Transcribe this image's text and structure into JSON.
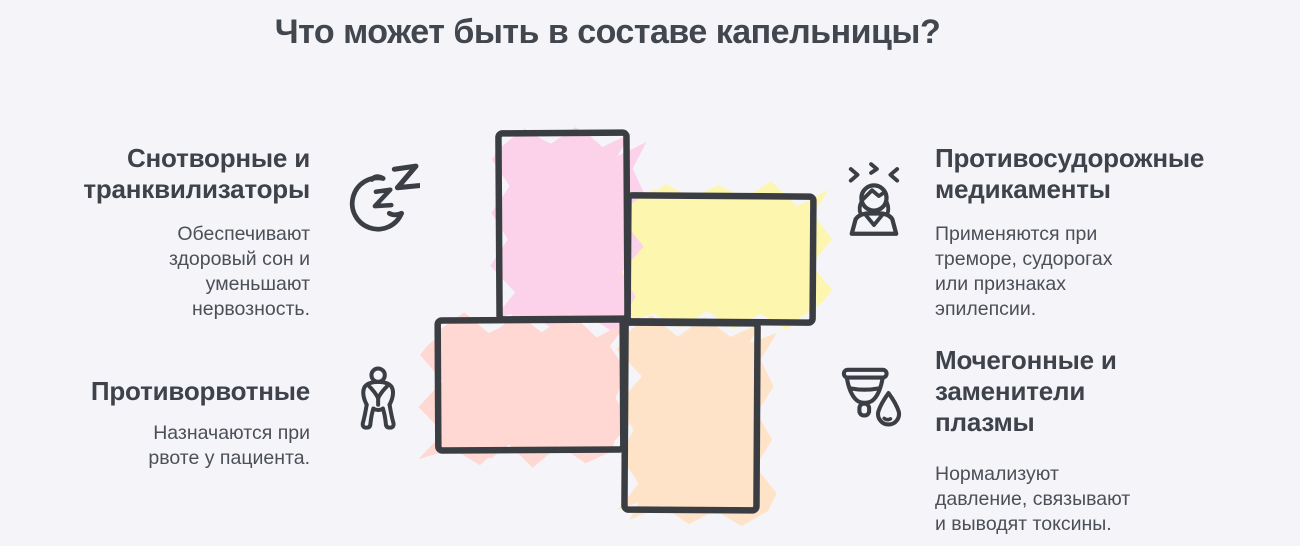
{
  "title": "Что может быть в составе капельницы?",
  "colors": {
    "background": "#f5f5f9",
    "heading_text": "#3e424a",
    "body_text": "#4b4f57",
    "outline": "#3a3d42",
    "pink": "#fcd2ea",
    "yellow": "#fdf6ae",
    "salmon": "#ffd7d3",
    "orange": "#fee3c8"
  },
  "items": [
    {
      "id": "sedatives",
      "icon": "sleep-moon-icon",
      "title": "Снотворные и\nтранквилизаторы",
      "description": "Обеспечивают\nздоровый сон и\nуменьшают\nнервозность."
    },
    {
      "id": "anticonvulsants",
      "icon": "tremor-person-icon",
      "title": "Противосудорожные\nмедикаменты",
      "description": "Применяются при\nтреморе, судорогах\nили признаках\nэпилепсии."
    },
    {
      "id": "antiemetics",
      "icon": "nausea-person-icon",
      "title": "Противорвотные",
      "description": "Назначаются при\nрвоте у пациента."
    },
    {
      "id": "diuretics",
      "icon": "cup-droplet-icon",
      "title": "Мочегонные и\nзаменители\nплазмы",
      "description": "Нормализуют\nдавление, связывают\nи выводят токсины."
    }
  ]
}
